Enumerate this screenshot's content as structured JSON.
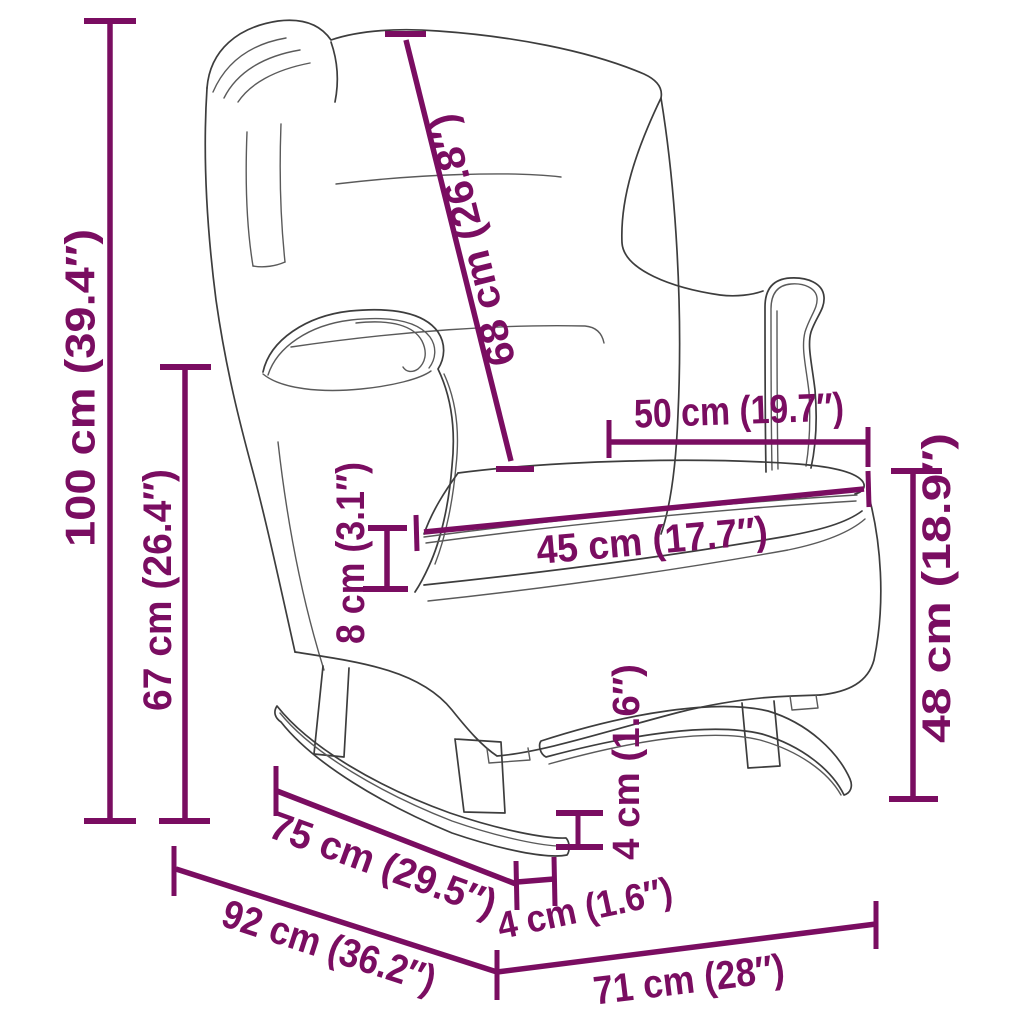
{
  "diagram": {
    "type": "product-dimension-line-drawing",
    "subject": "wingback rocking chair with rocker skids",
    "background_color": "#ffffff",
    "accent_color": "#7a0d61",
    "line_art_color": "#3d3d3d",
    "dimensions": [
      {
        "id": "total-height",
        "label": "100 cm (39.4″)",
        "cm": 100,
        "inch": 39.4
      },
      {
        "id": "height-to-armrest",
        "label": "67 cm (26.4″)",
        "cm": 67,
        "inch": 26.4
      },
      {
        "id": "backrest-diagonal",
        "label": "68 cm (26.8″)",
        "cm": 68,
        "inch": 26.8
      },
      {
        "id": "seat-depth",
        "label": "50 cm (19.7″)",
        "cm": 50,
        "inch": 19.7
      },
      {
        "id": "seat-width",
        "label": "45 cm (17.7″)",
        "cm": 45,
        "inch": 17.7
      },
      {
        "id": "cushion-thickness",
        "label": "8 cm (3.1″)",
        "cm": 8,
        "inch": 3.1
      },
      {
        "id": "seat-height",
        "label": "48 cm (18.9″)",
        "cm": 48,
        "inch": 18.9
      },
      {
        "id": "rocker-height",
        "label": "4 cm (1.6″)",
        "cm": 4,
        "inch": 1.6
      },
      {
        "id": "rocker-overhang",
        "label": "4 cm (1.6″)",
        "cm": 4,
        "inch": 1.6
      },
      {
        "id": "rocker-length",
        "label": "75 cm (29.5″)",
        "cm": 75,
        "inch": 29.5
      },
      {
        "id": "total-depth",
        "label": "92 cm (36.2″)",
        "cm": 92,
        "inch": 36.2
      },
      {
        "id": "total-width",
        "label": "71 cm (28″)",
        "cm": 71,
        "inch": 28
      }
    ]
  }
}
